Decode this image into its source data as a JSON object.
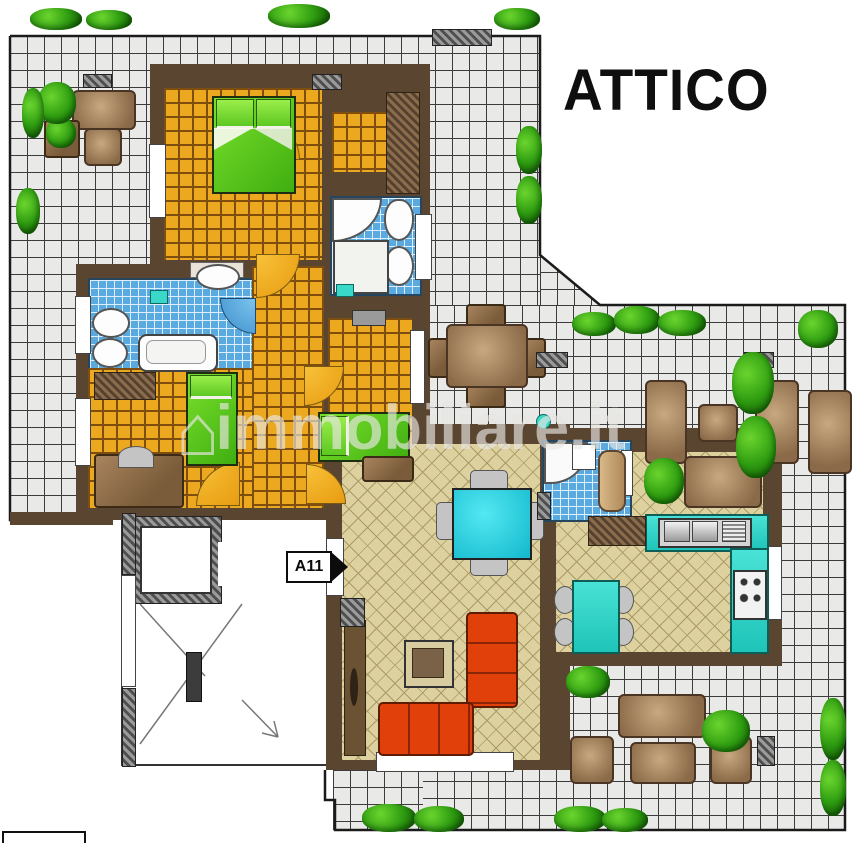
{
  "header": {
    "title": "ATTICO"
  },
  "entrance": {
    "label": "A11"
  },
  "watermark": {
    "logo_icon": "house-icon",
    "logo_glyph": "⌂",
    "text": "immobiliare.it"
  },
  "colors": {
    "terrace_tile": "#e9e9e7",
    "tile_line": "#3c3c3c",
    "floor_orange": "#eca81f",
    "floor_orange_line": "#7d4e0e",
    "floor_parquet": "#ded1a0",
    "parquet_line": "#ab9a64",
    "bathroom_blue": "#5baadf",
    "bathroom_line": "#ddeefc",
    "wall_brown": "#5a4530",
    "bed_green": "#3fae10",
    "sofa_red": "#e2400b",
    "kitchen_teal": "#1fc4b8",
    "table_cyan": "#12b8cc",
    "plant_green": "#2f9e11",
    "title_black": "#0f0f0f"
  }
}
